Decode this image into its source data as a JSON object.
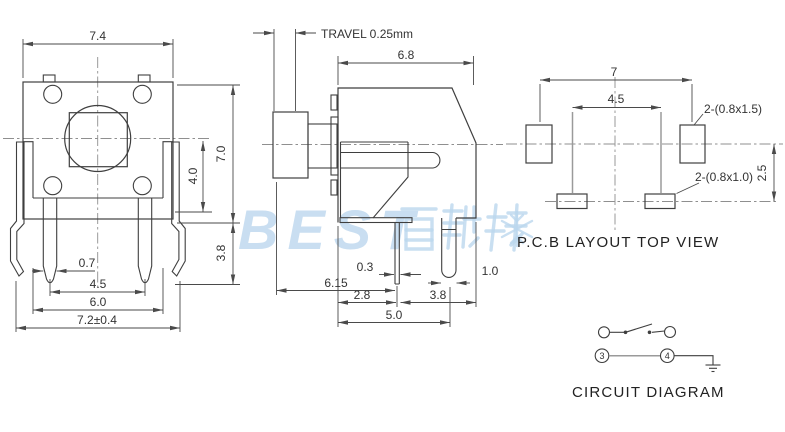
{
  "watermark": {
    "brand_text": "BEST",
    "color": "#bcd7ee"
  },
  "front_view": {
    "dim_width": "7.4",
    "dim_height": "7.0",
    "dim_center_to_base": "4.0",
    "dim_pin_drop": "3.8",
    "dim_pin_width": "0.7",
    "dim_pin_pitch": "4.5",
    "dim_base_width": "6.0",
    "dim_overall_width": "7.2±0.4"
  },
  "side_view": {
    "travel_label": "TRAVEL  0.25mm",
    "dim_body_depth": "6.8",
    "dim_pin_thickness": "0.3",
    "dim_button_to_pin": "6.15",
    "dim_face_to_pin": "2.8",
    "dim_pin_to_back": "3.8",
    "dim_back_pin_width": "1.0",
    "dim_pin_span": "5.0"
  },
  "pcb_layout": {
    "dim_outer_pitch": "7",
    "dim_inner_pitch": "4.5",
    "dim_row_offset": "2.5",
    "label_outer_pads": "2-(0.8x1.5)",
    "label_inner_pads": "2-(0.8x1.0)",
    "caption": "P.C.B LAYOUT",
    "caption_2": "TOP VIEW"
  },
  "circuit_diagram": {
    "terminal_left": "3",
    "terminal_right": "4",
    "caption": "CIRCUIT DIAGRAM"
  }
}
